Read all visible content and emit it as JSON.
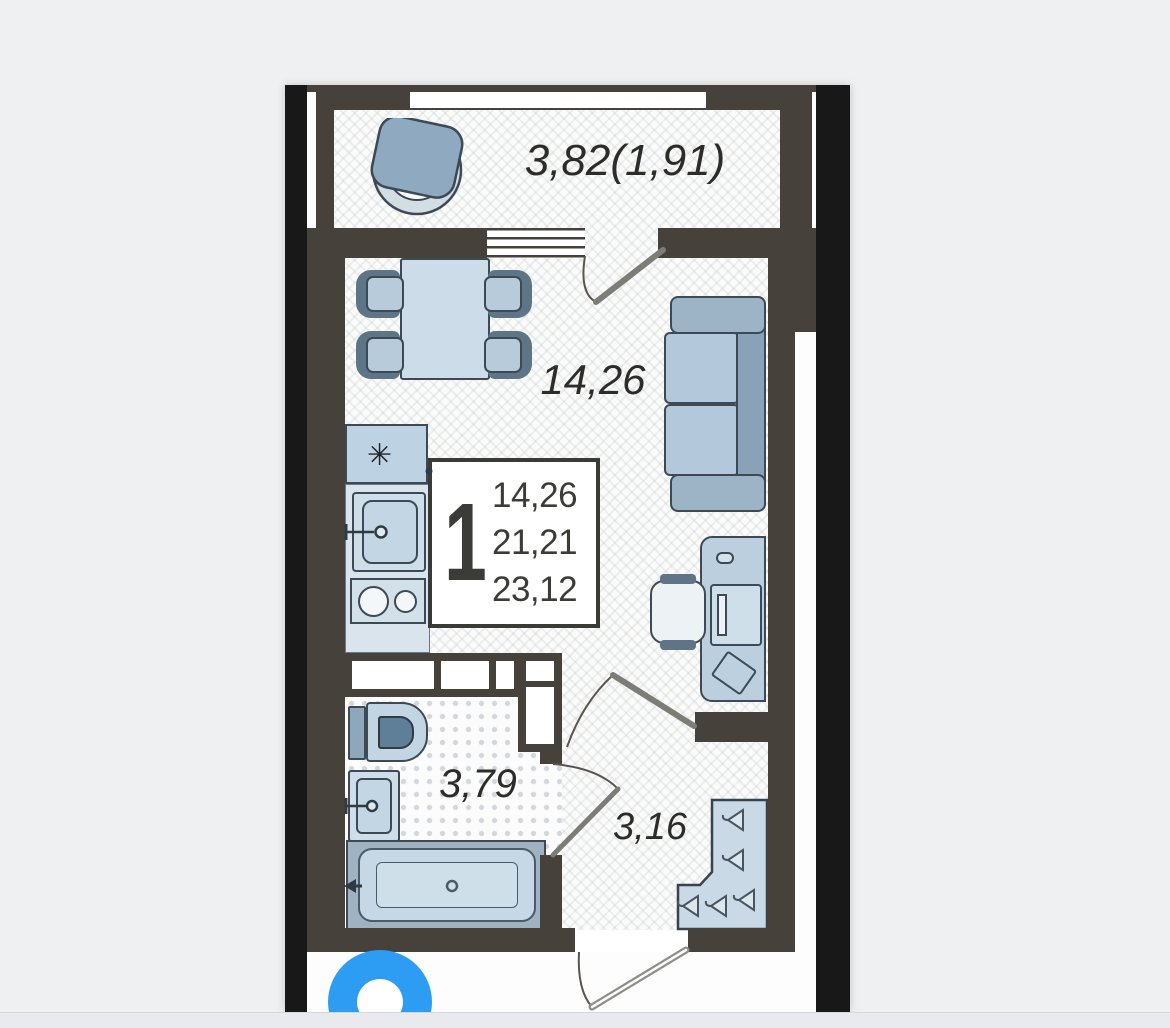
{
  "title": "Studio apartment floor plan",
  "labels": {
    "balcony_area": "3,82(1,91)",
    "room_area": "14,26",
    "bathroom_area": "3,79",
    "hallway_area": "3,16"
  },
  "info_box": {
    "room_count": "1",
    "living_area": "14,26",
    "apartment_area": "21,21",
    "total_area": "23,12"
  },
  "glyphs": {
    "snowflake": "✳"
  },
  "colors": {
    "wall": "#46413b",
    "frame_bars": "#181818",
    "furniture_fill": "#c6d8e5",
    "furniture_outline": "#3d4954",
    "logo_blue": "#2d9cf3",
    "page_bg": "#eff0f2"
  }
}
